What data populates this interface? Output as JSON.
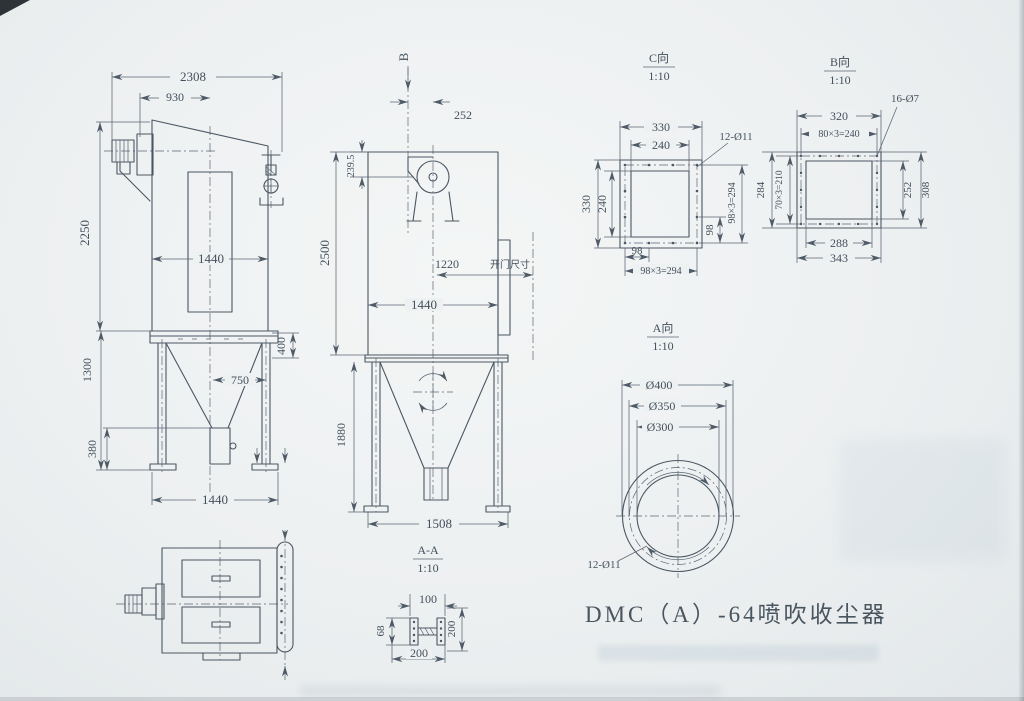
{
  "title": "DMC（A）-64喷吹收尘器",
  "front_view": {
    "dim_overall_width": "2308",
    "dim_fan_offset": "930",
    "dim_body_height": "2250",
    "dim_body_width": "1440",
    "dim_frame_height": "1300",
    "dim_hopper_offset": "750",
    "dim_outlet_height": "380",
    "dim_base_width": "1440",
    "dim_beam_depth": "400"
  },
  "side_view": {
    "section_label": "B",
    "dim_outlet_offset": "252",
    "dim_fan_drop": "239.5",
    "dim_body_height": "2500",
    "dim_door_swing": "1220",
    "door_note": "开门尺寸",
    "dim_body_width": "1440",
    "dim_frame_height": "1880",
    "dim_base_width": "1508"
  },
  "view_c": {
    "label": "C向",
    "scale": "1:10",
    "holes": "12-Ø11",
    "dim_width_outer": "330",
    "dim_width_inner": "240",
    "dim_height_outer": "330",
    "dim_height_inner": "240",
    "dim_hole_pitch_v": "98",
    "dim_hole_span_v": "98×3=294",
    "dim_hole_pitch_h": "98",
    "dim_hole_span_h": "98×3=294"
  },
  "view_b": {
    "label": "B向",
    "scale": "1:10",
    "holes": "16-Ø7",
    "dim_width_outer": "320",
    "dim_hole_span_h": "80×3=240",
    "dim_height_outer": "284",
    "dim_hole_span_v": "70×3=210",
    "dim_opening_height": "252",
    "dim_flange_height": "308",
    "dim_opening_width": "288",
    "dim_flange_width": "343"
  },
  "view_a": {
    "label": "A向",
    "scale": "1:10",
    "holes": "12-Ø11",
    "dim_flange_od": "Ø400",
    "dim_bolt_circle": "Ø350",
    "dim_bore": "Ø300"
  },
  "section_aa": {
    "label": "A-A",
    "scale": "1:10",
    "dim_flange_width": "100",
    "dim_beam_depth": "68",
    "dim_height": "200",
    "dim_width": "200"
  }
}
